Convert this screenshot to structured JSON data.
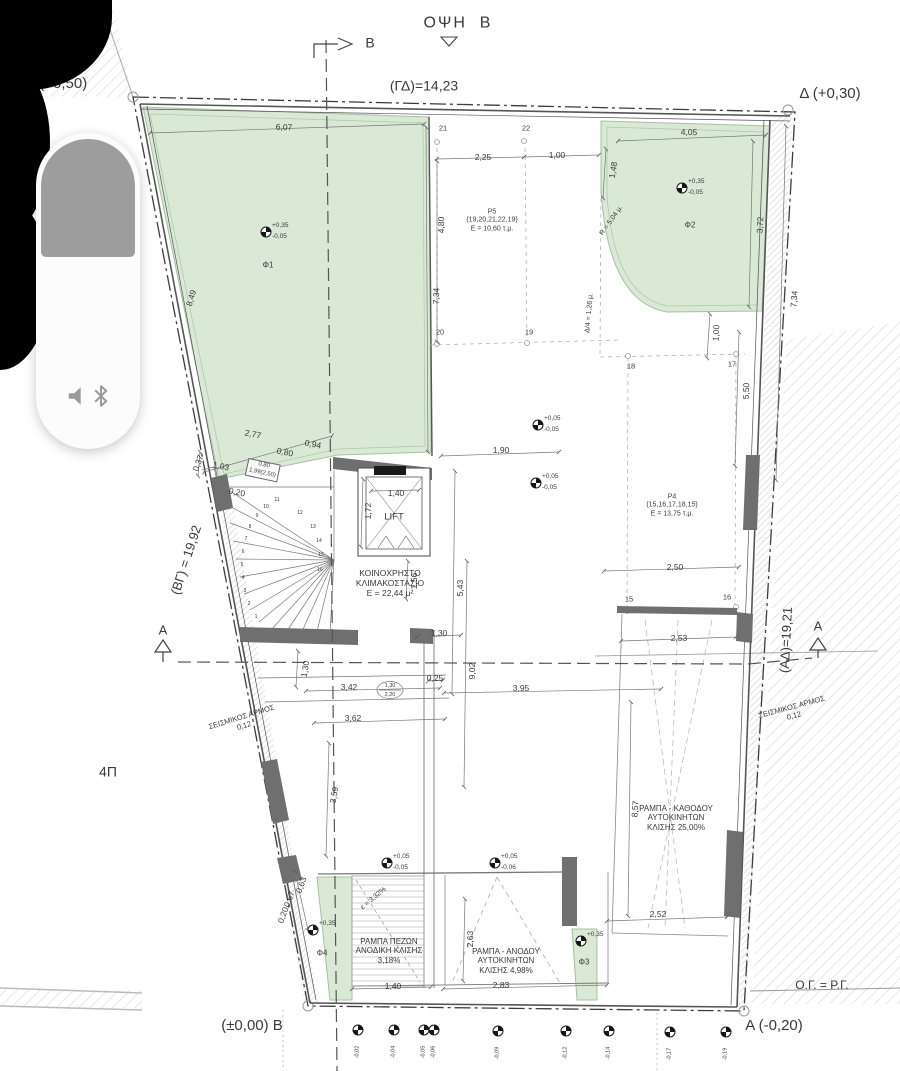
{
  "colors": {
    "paper": "#ffffff",
    "planted_area_fill": "#d9e9d5",
    "planted_area_border": "#a3c3a0",
    "wall_fill": "#6f6f6f",
    "line": "#555555",
    "hatch": "#c9c9c9",
    "overlay_gray": "#9d9d9d"
  },
  "volume_overlay": {
    "icons": [
      "speaker-icon",
      "bluetooth-icon"
    ]
  },
  "plan": {
    "labels": [
      {
        "t": "ΟΨΗ  Β",
        "x": 458,
        "y": 24,
        "s": 16,
        "ls": 2,
        "n": "view-title"
      },
      {
        "t": "Β",
        "x": 370,
        "y": 43,
        "s": 14,
        "n": "section-mark-b-label"
      },
      {
        "t": "Γ (+0,50)",
        "x": 57,
        "y": 84,
        "s": 15,
        "n": "corner-label-gamma"
      },
      {
        "t": "(ΓΔ)=14,23",
        "x": 424,
        "y": 86,
        "s": 14,
        "n": "boundary-dim-gd"
      },
      {
        "t": "Δ (+0,30)",
        "x": 830,
        "y": 94,
        "s": 15,
        "n": "corner-label-delta"
      },
      {
        "t": "(ΒΓ) = 19,92",
        "x": 186,
        "y": 560,
        "r": -72,
        "s": 13,
        "n": "boundary-dim-bg"
      },
      {
        "t": "(ΑΔ)=19,21",
        "x": 786,
        "y": 640,
        "r": -87,
        "s": 13,
        "n": "boundary-dim-ad"
      },
      {
        "t": "ΣΕΙΣΜΙΚΟΣ ΑΡΜΟΣ\n0,12",
        "x": 243,
        "y": 722,
        "r": -17,
        "s": 7.5,
        "n": "seismic-joint-label-left"
      },
      {
        "t": "ΣΕΙΣΜΙΚΟΣ ΑΡΜΟΣ\n0,12",
        "x": 793,
        "y": 712,
        "r": -15,
        "s": 7.5,
        "n": "seismic-joint-label-right"
      },
      {
        "t": "4Π",
        "x": 108,
        "y": 772,
        "s": 14,
        "n": "zone-label"
      },
      {
        "t": "(±0,00) Β",
        "x": 252,
        "y": 1026,
        "s": 15,
        "n": "corner-label-beta"
      },
      {
        "t": "Α (-0,20)",
        "x": 774,
        "y": 1026,
        "s": 15,
        "n": "corner-label-alpha"
      },
      {
        "t": "Ο.Γ. = Ρ.Γ.",
        "x": 822,
        "y": 985,
        "s": 12,
        "n": "note-og-rg"
      },
      {
        "t": "ΚΟΙΝΟΧΡΗΣΤΟ\nΚΛΙΜΑΚΟΣΤΑΣΙΟ\nΕ = 22,44 μ²",
        "x": 390,
        "y": 583,
        "s": 8.5,
        "n": "room-label-staircase"
      },
      {
        "t": "LIFT",
        "x": 394,
        "y": 517,
        "s": 9.5,
        "n": "room-label-lift"
      },
      {
        "t": "Ρ5\n(19,20,21,22,19)\nΕ = 10,60 τ.μ.",
        "x": 492,
        "y": 221,
        "s": 7,
        "n": "room-label-p5"
      },
      {
        "t": "Ρ4\n(15,16,17,18,15)\nΕ = 13,75 τ.μ.",
        "x": 672,
        "y": 506,
        "s": 7,
        "n": "room-label-p4"
      },
      {
        "t": "ΡΑΜΠΑ ΠΕΖΩΝ\nΑΝΟΔΙΚΗ ΚΛΙΣΗΣ\n3,18%",
        "x": 389,
        "y": 951,
        "s": 8,
        "n": "ramp-label-pedestrian"
      },
      {
        "t": "ΡΑΜΠΑ - ΑΝΟΔΟΥ\nΑΥΤΟΚΙΝΗΤΩΝ\nΚΛΙΣΗΣ 4,98%",
        "x": 506,
        "y": 961,
        "s": 8,
        "n": "ramp-label-car-up"
      },
      {
        "t": "ΡΑΜΠΑ - ΚΑΘΟΔΟΥ\nΑΥΤΟΚΙΝΗΤΩΝ\nΚΛΙΣΗΣ 25,00%",
        "x": 676,
        "y": 818,
        "s": 8,
        "n": "ramp-label-car-down"
      },
      {
        "t": "Φ1",
        "x": 268,
        "y": 265,
        "s": 8,
        "n": "area-label-f1"
      },
      {
        "t": "Φ2",
        "x": 690,
        "y": 225,
        "s": 8,
        "n": "area-label-f2"
      },
      {
        "t": "Φ3",
        "x": 584,
        "y": 962,
        "s": 8,
        "n": "area-label-f3"
      },
      {
        "t": "Φ4",
        "x": 322,
        "y": 953,
        "s": 8,
        "n": "area-label-f4"
      },
      {
        "t": "R = 5,04 μ.",
        "x": 612,
        "y": 221,
        "r": -55,
        "s": 7,
        "n": "radius-note"
      },
      {
        "t": "Δ/4 = 1,26 μ.",
        "x": 590,
        "y": 313,
        "r": -85,
        "s": 7,
        "n": "setback-note"
      },
      {
        "t": "ε = 3,32%",
        "x": 374,
        "y": 899,
        "r": -40,
        "s": 7,
        "n": "slope-note"
      },
      {
        "t": "1,30",
        "x": 390,
        "y": 686,
        "s": 5.5,
        "n": "door-tag"
      },
      {
        "t": "2,20",
        "x": 390,
        "y": 695,
        "s": 5.5,
        "n": "door-tag"
      },
      {
        "t": "6,07",
        "x": 284,
        "y": 127,
        "r": 2
      },
      {
        "t": "8,49",
        "x": 191,
        "y": 298,
        "r": -73
      },
      {
        "t": "7,34",
        "x": 436,
        "y": 296,
        "r": -88
      },
      {
        "t": "2,25",
        "x": 483,
        "y": 157
      },
      {
        "t": "1,00",
        "x": 557,
        "y": 155
      },
      {
        "t": "1,48",
        "x": 613,
        "y": 170,
        "r": -80
      },
      {
        "t": "4,05",
        "x": 689,
        "y": 132,
        "r": 2
      },
      {
        "t": "3,72",
        "x": 760,
        "y": 225,
        "r": -87
      },
      {
        "t": "7,34",
        "x": 794,
        "y": 299,
        "r": -86
      },
      {
        "t": "4,80",
        "x": 441,
        "y": 225,
        "r": -89
      },
      {
        "t": "1,00",
        "x": 716,
        "y": 333,
        "r": -87
      },
      {
        "t": "5,50",
        "x": 746,
        "y": 391,
        "r": -88
      },
      {
        "t": "2,77",
        "x": 253,
        "y": 434,
        "r": 12
      },
      {
        "t": "0,80",
        "x": 285,
        "y": 452,
        "r": 12
      },
      {
        "t": "0,94",
        "x": 313,
        "y": 444,
        "r": 12
      },
      {
        "t": "1,03",
        "x": 221,
        "y": 466,
        "r": 12
      },
      {
        "t": "0,20",
        "x": 237,
        "y": 492,
        "r": 12
      },
      {
        "t": "0,37",
        "x": 198,
        "y": 463,
        "r": -70
      },
      {
        "t": "1,90",
        "x": 501,
        "y": 450
      },
      {
        "t": "1,40",
        "x": 396,
        "y": 493
      },
      {
        "t": "1,72",
        "x": 368,
        "y": 511,
        "r": -89
      },
      {
        "t": "1,56",
        "x": 414,
        "y": 581,
        "r": -89
      },
      {
        "t": "1,30",
        "x": 439,
        "y": 633
      },
      {
        "t": "5,43",
        "x": 460,
        "y": 588,
        "r": -89
      },
      {
        "t": "9,02",
        "x": 472,
        "y": 671,
        "r": -89
      },
      {
        "t": "1,30",
        "x": 305,
        "y": 669,
        "r": -80
      },
      {
        "t": "3,42",
        "x": 349,
        "y": 687
      },
      {
        "t": "3,62",
        "x": 353,
        "y": 718
      },
      {
        "t": "0,25",
        "x": 435,
        "y": 678
      },
      {
        "t": "3,95",
        "x": 521,
        "y": 688
      },
      {
        "t": "2,50",
        "x": 675,
        "y": 567
      },
      {
        "t": "2,53",
        "x": 679,
        "y": 638
      },
      {
        "t": "8,57",
        "x": 635,
        "y": 809,
        "r": -86
      },
      {
        "t": "2,52",
        "x": 658,
        "y": 914
      },
      {
        "t": "3,59",
        "x": 334,
        "y": 795,
        "r": -80
      },
      {
        "t": "0,63",
        "x": 301,
        "y": 885,
        "r": -70
      },
      {
        "t": "0,67",
        "x": 289,
        "y": 899,
        "r": -70
      },
      {
        "t": "0,20",
        "x": 283,
        "y": 915,
        "r": -70
      },
      {
        "t": "2,63",
        "x": 470,
        "y": 939,
        "r": -89
      },
      {
        "t": "1,40",
        "x": 393,
        "y": 986
      },
      {
        "t": "2,83",
        "x": 501,
        "y": 985
      },
      {
        "t": "0,80\n1,99(2,50)",
        "x": 263,
        "y": 470,
        "r": 12,
        "s": 6,
        "b": true,
        "n": "opening-tag"
      },
      {
        "t": "21",
        "x": 443,
        "y": 129,
        "s": 7.5,
        "n": "grid-point-label"
      },
      {
        "t": "22",
        "x": 526,
        "y": 129,
        "s": 7.5,
        "n": "grid-point-label"
      },
      {
        "t": "20",
        "x": 440,
        "y": 333,
        "s": 7.5,
        "n": "grid-point-label"
      },
      {
        "t": "19",
        "x": 529,
        "y": 333,
        "s": 7.5,
        "n": "grid-point-label"
      },
      {
        "t": "18",
        "x": 631,
        "y": 367,
        "s": 7.5,
        "n": "grid-point-label"
      },
      {
        "t": "17",
        "x": 732,
        "y": 365,
        "s": 7.5,
        "n": "grid-point-label"
      },
      {
        "t": "15",
        "x": 629,
        "y": 600,
        "s": 7.5,
        "n": "grid-point-label"
      },
      {
        "t": "16",
        "x": 727,
        "y": 598,
        "s": 7.5,
        "n": "grid-point-label"
      },
      {
        "t": "Α",
        "x": 163,
        "y": 630,
        "s": 13,
        "n": "section-mark-a-label"
      },
      {
        "t": "Α",
        "x": 818,
        "y": 626,
        "s": 13,
        "n": "section-mark-a-label"
      },
      {
        "t": "1",
        "x": 256,
        "y": 618,
        "s": 5,
        "n": "stair-number"
      },
      {
        "t": "2",
        "x": 249,
        "y": 605,
        "s": 5,
        "n": "stair-number"
      },
      {
        "t": "3",
        "x": 245,
        "y": 592,
        "s": 5,
        "n": "stair-number"
      },
      {
        "t": "4",
        "x": 243,
        "y": 579,
        "s": 5,
        "n": "stair-number"
      },
      {
        "t": "5",
        "x": 242,
        "y": 566,
        "s": 5,
        "n": "stair-number"
      },
      {
        "t": "6",
        "x": 243,
        "y": 553,
        "s": 5,
        "n": "stair-number"
      },
      {
        "t": "7",
        "x": 246,
        "y": 540,
        "s": 5,
        "n": "stair-number"
      },
      {
        "t": "8",
        "x": 250,
        "y": 528,
        "s": 5,
        "n": "stair-number"
      },
      {
        "t": "9",
        "x": 257,
        "y": 517,
        "s": 5,
        "n": "stair-number"
      },
      {
        "t": "10",
        "x": 266,
        "y": 508,
        "s": 5,
        "n": "stair-number"
      },
      {
        "t": "11",
        "x": 277,
        "y": 501,
        "s": 5,
        "n": "stair-number"
      },
      {
        "t": "12",
        "x": 300,
        "y": 514,
        "s": 5,
        "n": "stair-number"
      },
      {
        "t": "13",
        "x": 313,
        "y": 528,
        "s": 5,
        "n": "stair-number"
      },
      {
        "t": "14",
        "x": 319,
        "y": 542,
        "s": 5,
        "n": "stair-number"
      },
      {
        "t": "15",
        "x": 321,
        "y": 556,
        "s": 5,
        "n": "stair-number"
      },
      {
        "t": "16",
        "x": 320,
        "y": 571,
        "s": 5,
        "n": "stair-number"
      }
    ],
    "level_markers": [
      {
        "x": 266,
        "y": 232,
        "top": "+0,35",
        "bottom": "-0,05"
      },
      {
        "x": 682,
        "y": 188,
        "top": "+0,35",
        "bottom": "-0,05"
      },
      {
        "x": 538,
        "y": 425,
        "top": "+0,05",
        "bottom": "-0,05"
      },
      {
        "x": 536,
        "y": 483,
        "top": "+0,05",
        "bottom": "-0,05"
      },
      {
        "x": 387,
        "y": 863,
        "top": "+0,05",
        "bottom": "-0,05"
      },
      {
        "x": 495,
        "y": 863,
        "top": "+0,05",
        "bottom": "-0,06"
      },
      {
        "x": 313,
        "y": 930,
        "top": "+0,35"
      },
      {
        "x": 581,
        "y": 941,
        "top": "+0,35"
      }
    ],
    "bottom_level_markers": [
      {
        "x": 358,
        "y": 1030,
        "val": "-0,02"
      },
      {
        "x": 394,
        "y": 1030,
        "val": "-0,04"
      },
      {
        "x": 424,
        "y": 1030,
        "val": "-0,05"
      },
      {
        "x": 434,
        "y": 1030,
        "val": "-0,06"
      },
      {
        "x": 498,
        "y": 1031,
        "val": "-0,09"
      },
      {
        "x": 566,
        "y": 1031,
        "val": "-0,12"
      },
      {
        "x": 609,
        "y": 1031,
        "val": "-0,14"
      },
      {
        "x": 670,
        "y": 1032,
        "val": "-0,17"
      },
      {
        "x": 726,
        "y": 1032,
        "val": "-0,19"
      }
    ]
  }
}
